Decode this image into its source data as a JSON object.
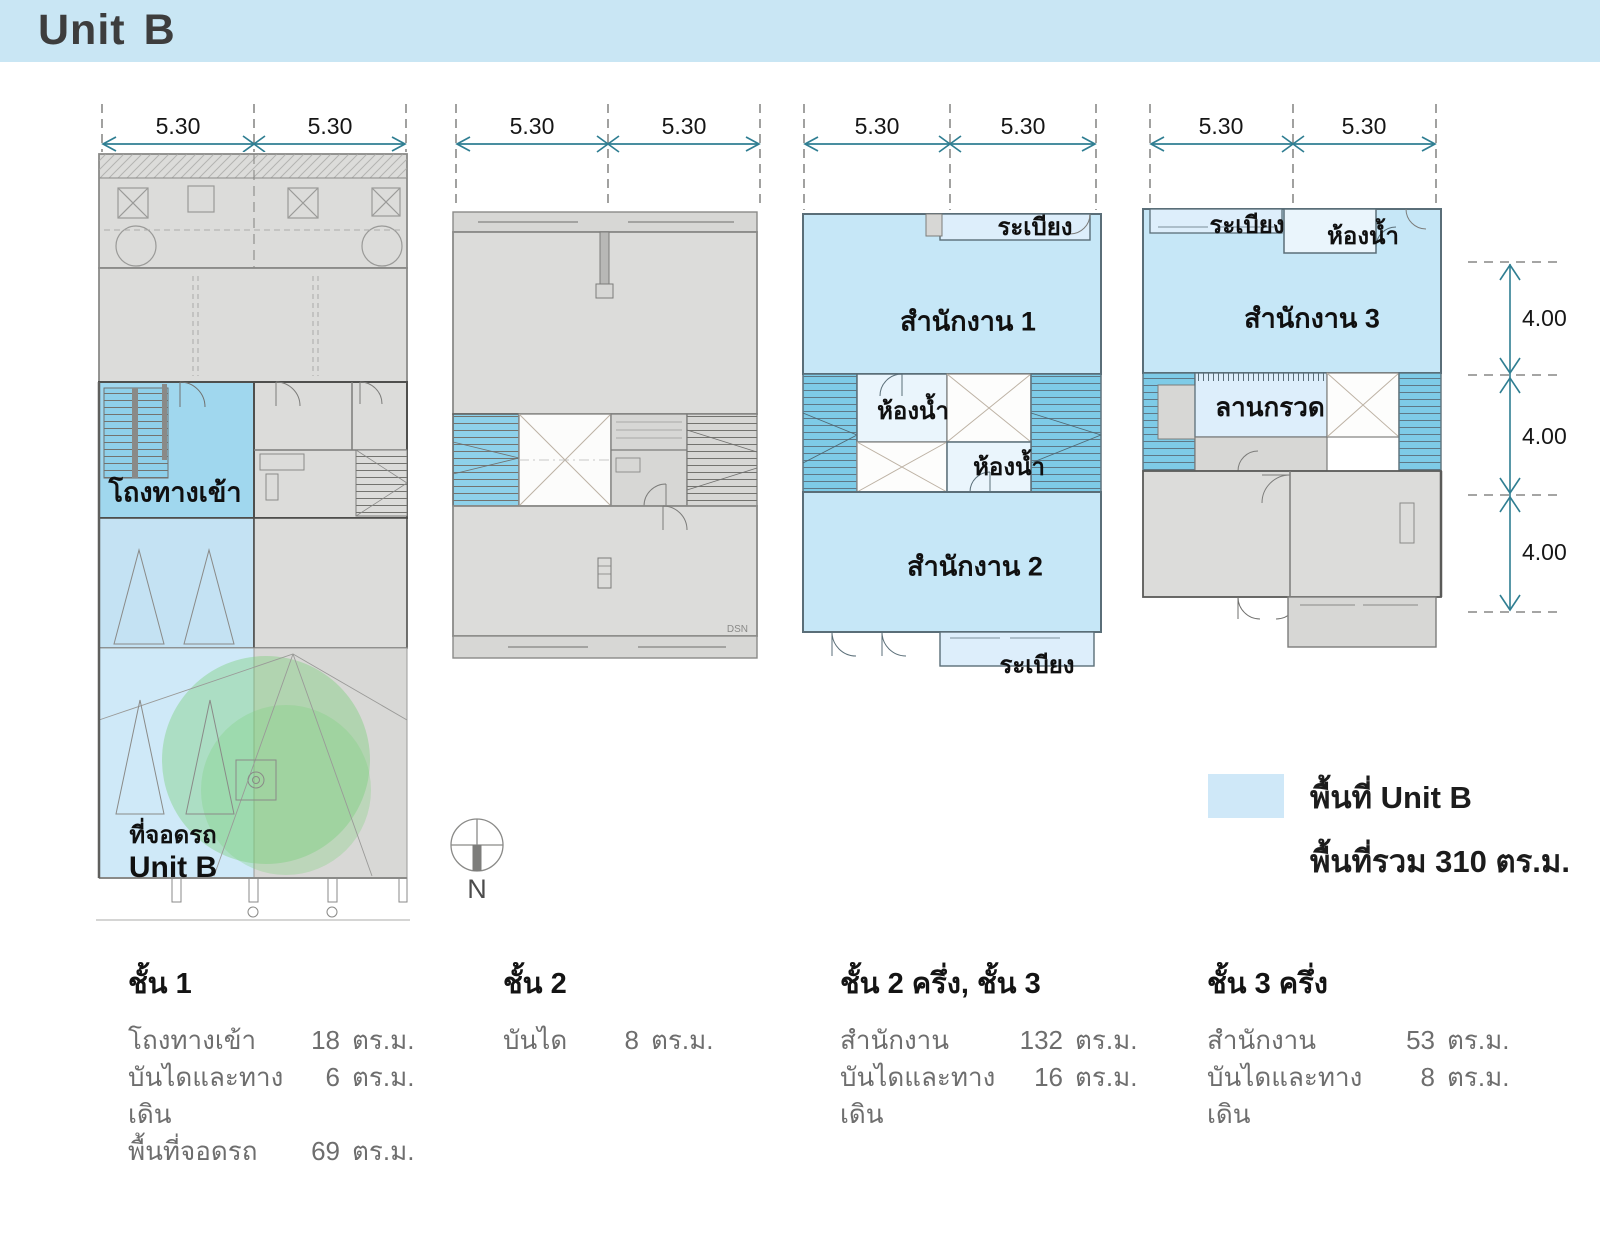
{
  "header": {
    "unit": "Unit",
    "b": "B",
    "banner_color": "#c9e6f4"
  },
  "dims": {
    "w": "5.30",
    "h": "4.00"
  },
  "plans": {
    "plan1": {
      "entrance": "โถงทางเข้า",
      "parking": "ที่จอดรถ",
      "unit": "Unit B"
    },
    "plan2": {
      "watermark": "DSN"
    },
    "plan3": {
      "balcony_top": "ระเบียง",
      "office1": "สำนักงาน 1",
      "bath1": "ห้องน้ำ",
      "bath2": "ห้องน้ำ",
      "office2": "สำนักงาน 2",
      "balcony_bottom": "ระเบียง"
    },
    "plan4": {
      "balcony": "ระเบียง",
      "bath": "ห้องน้ำ",
      "office3": "สำนักงาน 3",
      "gravel": "ลานกรวด"
    }
  },
  "compass": {
    "label": "N"
  },
  "legend": {
    "swatch_color": "#cfe8f8",
    "area_label": "พื้นที่ Unit B",
    "total_label": "พื้นที่รวม 310 ตร.ม."
  },
  "floors": [
    {
      "title": "ชั้น 1",
      "rows": [
        {
          "label": "โถงทางเข้า",
          "area": "18",
          "unit": "ตร.ม."
        },
        {
          "label": "บันไดและทางเดิน",
          "area": "6",
          "unit": "ตร.ม."
        },
        {
          "label": "พื้นที่จอดรถ",
          "area": "69",
          "unit": "ตร.ม."
        }
      ]
    },
    {
      "title": "ชั้น 2",
      "rows": [
        {
          "label": "บันได",
          "area": "8",
          "unit": "ตร.ม."
        }
      ]
    },
    {
      "title": "ชั้น 2 ครึ่ง, ชั้น 3",
      "rows": [
        {
          "label": "สำนักงาน",
          "area": "132",
          "unit": "ตร.ม."
        },
        {
          "label": "บันไดและทางเดิน",
          "area": "16",
          "unit": "ตร.ม."
        }
      ]
    },
    {
      "title": "ชั้น 3 ครึ่ง",
      "rows": [
        {
          "label": "สำนักงาน",
          "area": "53",
          "unit": "ตร.ม."
        },
        {
          "label": "บันไดและทางเดิน",
          "area": "8",
          "unit": "ตร.ม."
        }
      ]
    }
  ],
  "colors": {
    "banner": "#c9e6f4",
    "unit_area_fill": "#c6e7f7",
    "entrance_fill": "#a0d7ee",
    "stair_fill": "#7ecbe7",
    "parking_fill": "#cfe9f8",
    "plan_gray": "#dcdcda",
    "dimension_teal": "#2f7e92",
    "landscape_green": "#7ccf7c"
  }
}
